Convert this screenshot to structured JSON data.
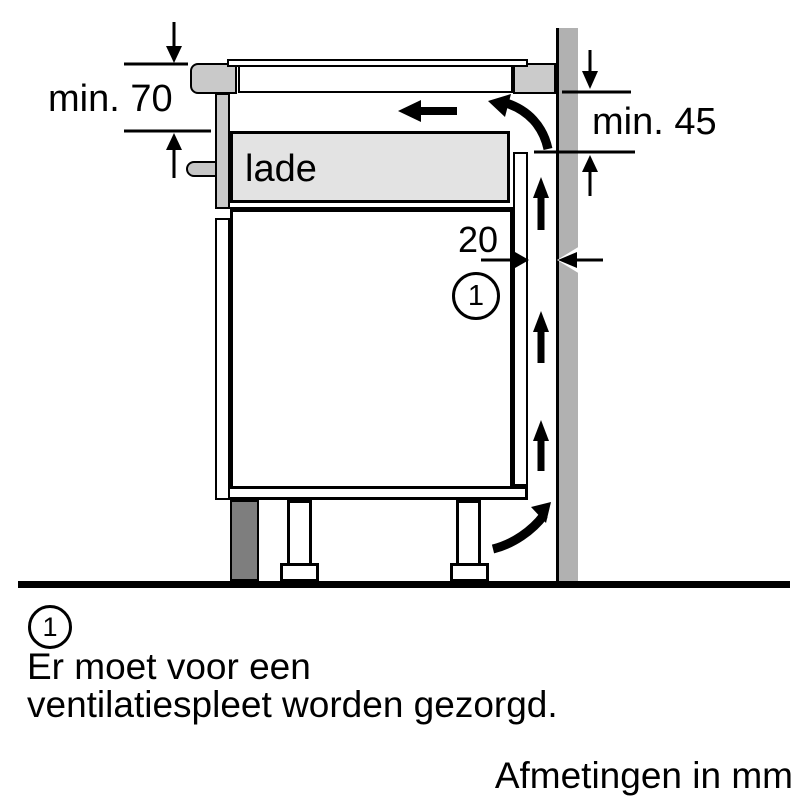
{
  "diagram": {
    "drawer_label": "lade",
    "callout": "1",
    "dimensions": {
      "top_clearance": "min. 70",
      "back_clearance": "min. 45",
      "vent_gap": "20"
    },
    "colors": {
      "wall": "#b1b1b1",
      "worktop": "#cbcbcb",
      "drawer_fill": "#e3e3e3",
      "plinth": "#7e7e7e",
      "line": "#000000",
      "background": "#ffffff"
    }
  },
  "legend": {
    "ref": "1",
    "line1": "Er moet voor een",
    "line2": "ventilatiespleet worden gezorgd."
  },
  "footer": {
    "units": "Afmetingen in mm"
  }
}
